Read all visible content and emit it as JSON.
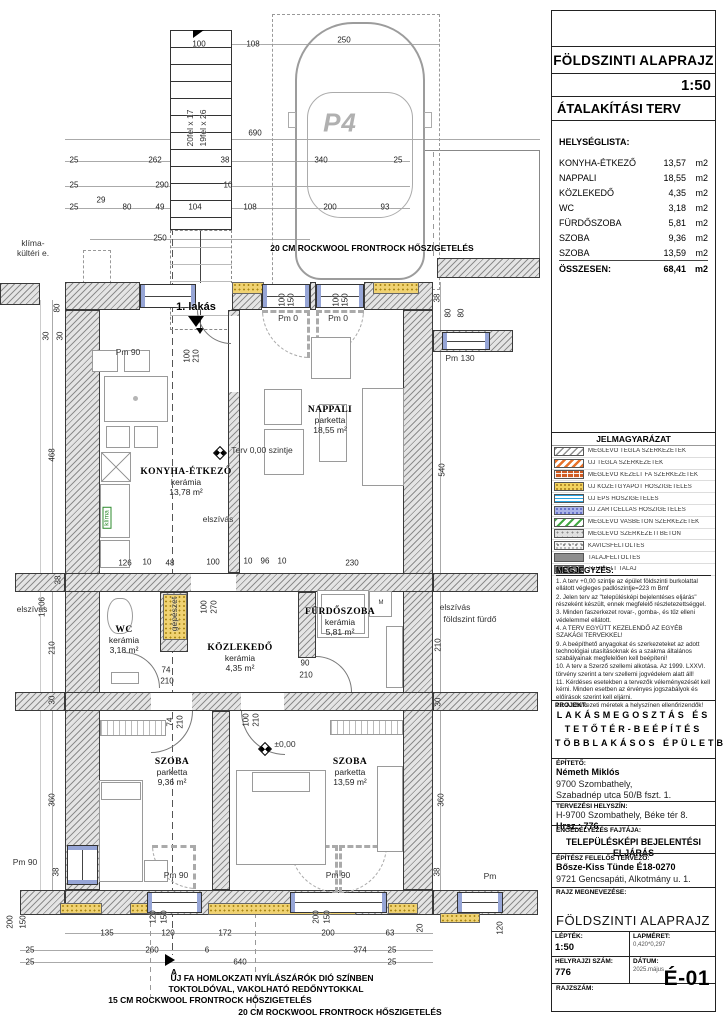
{
  "title_block": {
    "title": "FÖLDSZINTI ALAPRAJZ",
    "scale": "1:50",
    "subtitle": "ÁTALAKÍTÁSI TERV",
    "room_list": {
      "heading": "HELYSÉGLISTA:",
      "rows": [
        {
          "name": "KONYHA-ÉTKEZŐ",
          "area": "13,57",
          "unit": "m2"
        },
        {
          "name": "NAPPALI",
          "area": "18,55",
          "unit": "m2"
        },
        {
          "name": "KÖZLEKEDŐ",
          "area": "4,35",
          "unit": "m2"
        },
        {
          "name": "WC",
          "area": "3,18",
          "unit": "m2"
        },
        {
          "name": "FÜRDŐSZOBA",
          "area": "5,81",
          "unit": "m2"
        },
        {
          "name": "SZOBA",
          "area": "9,36",
          "unit": "m2"
        },
        {
          "name": "SZOBA",
          "area": "13,59",
          "unit": "m2"
        }
      ],
      "total_label": "ÖSSZESEN:",
      "total_area": "68,41",
      "total_unit": "m2"
    },
    "legend": {
      "heading": "JELMAGYARÁZAT",
      "items": [
        {
          "label": "MEGLÉVŐ TÉGLA SZERKEZETEK",
          "cls": "sw1"
        },
        {
          "label": "ÚJ TÉGLA SZERKEZETEK",
          "cls": "sw2"
        },
        {
          "label": "MEGLÉVŐ KEZELT FA SZERKEZETEK",
          "cls": "sw3"
        },
        {
          "label": "ÚJ KŐZETGYAPOT HŐSZIGETELÉS",
          "cls": "sw4"
        },
        {
          "label": "ÚJ EPS HŐSZIGETELÉS",
          "cls": "sw5"
        },
        {
          "label": "ÚJ ZÁRTCELLÁS HŐSZIGETELÉS",
          "cls": "sw6"
        },
        {
          "label": "MEGLÉVŐ VASBETON SZERKEZETEK",
          "cls": "sw7"
        },
        {
          "label": "MEGLÉVŐ SZERKEZETI BETON",
          "cls": "sw8"
        },
        {
          "label": "KAVICSFELTÖLTÉS",
          "cls": "sw9"
        },
        {
          "label": "TALAJFELTÖLTÉS",
          "cls": "sw10"
        },
        {
          "label": "TERMETT TALAJ",
          "cls": "sw11"
        }
      ]
    },
    "notes": {
      "heading": "MEGJEGYZÉS:",
      "items": [
        "1. A terv +0,00 szintje az épület földszinti burkolattal ellátott végleges padlószintje=223 m Bmf",
        "2. Jelen terv az \"településképi bejelentéses eljárás\" részeként készült, ennek megfelelő részletezettséggel.",
        "3. Minden faszerkezet rovar-, gomba-, és tűz elleni védelemmel ellátott.",
        "4. A TERV EGYÜTT KEZELENDŐ AZ EGYÉB SZAKÁGI TERVEKKEL!",
        "9. A beépíthető anyagokat és szerkezeteket az adott technológiai utasításoknak és a szakma általános szabályainak megfelelően kell beépíteni!",
        "10. A terv a Szerző szellemi alkotása. Az 1999. LXXVI. törvény szerint a terv szellemi jogvédelem alatt áll!",
        "11. Kérdéses esetekben a tervezők véleményezését kell kérni. Minden esetben az érvényes jogszabályok és előírások szerint kell eljárni.",
        "12. A szerkezeti méretek a helyszínen ellenőrizendők!"
      ]
    },
    "project": {
      "heading": "PROJEKT:",
      "name_lines": [
        "LAKÁSMEGOSZTÁS ÉS",
        "TETŐTÉR-BEÉPÍTÉS",
        "TÖBBLAKÁSOS ÉPÜLETBEN"
      ],
      "client_label": "ÉPÍTETŐ:",
      "client_name": "Németh Miklós",
      "client_addr1": "9700 Szombathely,",
      "client_addr2": "Szabadnép utca 50/B fszt. 1.",
      "site_label": "TERVEZÉSI HELYSZÍN:",
      "site_addr": "H-9700 Szombathely, Béke tér 8.",
      "site_parcel": "Hrsz.: 776",
      "permit_label": "ENGEDÉLYEZÉS FAJTÁJA:",
      "permit_value": "TELEPÜLÉSKÉPI BEJELENTÉSI ELJÁRÁS",
      "architect_label": "ÉPÍTÉSZ FELELŐS TERVEZŐ:",
      "architect_name": "Bősze-Kiss Tünde É18-0270",
      "architect_addr": "9721 Gencsapáti, Alkotmány u. 1."
    },
    "footer": {
      "drawing_name_label": "RAJZ MEGNEVEZÉSE:",
      "drawing_name": "FÖLDSZINTI ALAPRAJZ",
      "scale_label": "LÉPTÉK:",
      "scale_value": "1:50",
      "sheet_size_label": "LAPMÉRET:",
      "sheet_size_value": "0,420*0,297",
      "parcel_label": "HELYRAJZI SZÁM:",
      "parcel_value": "776",
      "date_label": "DÁTUM:",
      "date_value": "2025.május",
      "drawing_no_label": "RAJZSZÁM:",
      "drawing_no_value": "É-01"
    }
  },
  "plan": {
    "rooms": [
      {
        "name": "KONYHA-ÉTKEZŐ",
        "finish": "kerámia",
        "area": "13,78 m²",
        "x": 186,
        "y": 482
      },
      {
        "name": "NAPPALI",
        "finish": "parketta",
        "area": "18,55 m²",
        "x": 330,
        "y": 420
      },
      {
        "name": "WC",
        "finish": "kerámia",
        "area": "3,18 m²",
        "x": 124,
        "y": 640
      },
      {
        "name": "KÖZLEKEDŐ",
        "finish": "kerámia",
        "area": "4,35 m²",
        "x": 240,
        "y": 658
      },
      {
        "name": "FÜRDŐSZOBA",
        "finish": "kerámia",
        "area": "5,81 m²",
        "x": 340,
        "y": 622
      },
      {
        "name": "SZOBA",
        "finish": "parketta",
        "area": "9,36 m²",
        "x": 172,
        "y": 772
      },
      {
        "name": "SZOBA",
        "finish": "parketta",
        "area": "13,59 m²",
        "x": 350,
        "y": 772
      }
    ],
    "annotations": [
      {
        "t": "klíma-",
        "x": 33,
        "y": 243
      },
      {
        "t": "kültéri e.",
        "x": 33,
        "y": 253
      },
      {
        "t": "20 CM ROCKWOOL FRONTROCK HŐSZIGETELÉS",
        "x": 372,
        "y": 248,
        "cls": "b"
      },
      {
        "t": "1. lakás",
        "x": 196,
        "y": 307,
        "cls": "b sec"
      },
      {
        "t": "Pm 90",
        "x": 128,
        "y": 352
      },
      {
        "t": "Pm 0",
        "x": 288,
        "y": 318
      },
      {
        "t": "Pm 0",
        "x": 338,
        "y": 318
      },
      {
        "t": "Pm 130",
        "x": 460,
        "y": 358
      },
      {
        "t": "Terv 0,00 szintje",
        "x": 262,
        "y": 450
      },
      {
        "t": "elszívás",
        "x": 218,
        "y": 519
      },
      {
        "t": "elszívás",
        "x": 32,
        "y": 609
      },
      {
        "t": "elszívás",
        "x": 455,
        "y": 607
      },
      {
        "t": "földszint fürdő",
        "x": 470,
        "y": 619
      },
      {
        "t": "gépészet",
        "x": 174,
        "y": 614,
        "cls": "v"
      },
      {
        "t": "klíma",
        "x": 107,
        "y": 518,
        "cls": "g"
      },
      {
        "t": "20fel x 17",
        "x": 190,
        "y": 128,
        "cls": "v"
      },
      {
        "t": "19fel x 26",
        "x": 203,
        "y": 128,
        "cls": "v"
      },
      {
        "t": "P4",
        "x": 340,
        "y": 123,
        "cls": "p4"
      },
      {
        "t": "±0,00",
        "x": 285,
        "y": 744
      },
      {
        "t": "M",
        "x": 381,
        "y": 603,
        "cls": "tiny"
      },
      {
        "t": "Pm 90",
        "x": 176,
        "y": 875
      },
      {
        "t": "Pm 90",
        "x": 338,
        "y": 875
      },
      {
        "t": "Pm 90",
        "x": 25,
        "y": 862
      },
      {
        "t": "Pm",
        "x": 490,
        "y": 876
      },
      {
        "t": "A",
        "x": 174,
        "y": 972,
        "cls": "b"
      },
      {
        "t": "ÚJ FA HOMLOKZATI NYÍLÁSZÁRÓK DIÓ SZÍNBEN",
        "x": 272,
        "y": 978,
        "cls": "nb"
      },
      {
        "t": "TOKTOLDÓVAL, VAKOLHATÓ REDŐNYTOKKAL",
        "x": 266,
        "y": 989,
        "cls": "nb"
      },
      {
        "t": "15 CM ROCKWOOL FRONTROCK HŐSZIGETELÉS",
        "x": 210,
        "y": 1000,
        "cls": "nb"
      },
      {
        "t": "20 CM ROCKWOOL FRONTROCK HŐSZIGETELÉS",
        "x": 340,
        "y": 1012,
        "cls": "nb"
      }
    ],
    "dimensions": [
      {
        "t": "100",
        "x": 199,
        "y": 44
      },
      {
        "t": "108",
        "x": 253,
        "y": 44
      },
      {
        "t": "250",
        "x": 344,
        "y": 40
      },
      {
        "t": "690",
        "x": 255,
        "y": 133
      },
      {
        "t": "25",
        "x": 74,
        "y": 160
      },
      {
        "t": "262",
        "x": 155,
        "y": 160
      },
      {
        "t": "38",
        "x": 225,
        "y": 160
      },
      {
        "t": "340",
        "x": 321,
        "y": 160
      },
      {
        "t": "25",
        "x": 398,
        "y": 160
      },
      {
        "t": "25",
        "x": 74,
        "y": 185
      },
      {
        "t": "290",
        "x": 162,
        "y": 185
      },
      {
        "t": "10",
        "x": 228,
        "y": 185
      },
      {
        "t": "25",
        "x": 74,
        "y": 207
      },
      {
        "t": "29",
        "x": 101,
        "y": 200
      },
      {
        "t": "80",
        "x": 127,
        "y": 207
      },
      {
        "t": "49",
        "x": 160,
        "y": 207
      },
      {
        "t": "104",
        "x": 195,
        "y": 207
      },
      {
        "t": "108",
        "x": 250,
        "y": 207
      },
      {
        "t": "200",
        "x": 330,
        "y": 207
      },
      {
        "t": "93",
        "x": 385,
        "y": 207
      },
      {
        "t": "250",
        "x": 160,
        "y": 238
      },
      {
        "t": "80",
        "x": 57,
        "y": 308,
        "cls": "v"
      },
      {
        "t": "30",
        "x": 46,
        "y": 336,
        "cls": "v"
      },
      {
        "t": "30",
        "x": 60,
        "y": 336,
        "cls": "v"
      },
      {
        "t": "468",
        "x": 52,
        "y": 455,
        "cls": "v"
      },
      {
        "t": "38",
        "x": 58,
        "y": 580,
        "cls": "v"
      },
      {
        "t": "1 106",
        "x": 42,
        "y": 607,
        "cls": "v"
      },
      {
        "t": "210",
        "x": 52,
        "y": 648,
        "cls": "v"
      },
      {
        "t": "30",
        "x": 52,
        "y": 700,
        "cls": "v"
      },
      {
        "t": "360",
        "x": 52,
        "y": 800,
        "cls": "v"
      },
      {
        "t": "38",
        "x": 56,
        "y": 872,
        "cls": "v"
      },
      {
        "t": "200",
        "x": 10,
        "y": 922,
        "cls": "v"
      },
      {
        "t": "150",
        "x": 23,
        "y": 922,
        "cls": "v"
      },
      {
        "t": "38",
        "x": 437,
        "y": 298,
        "cls": "v"
      },
      {
        "t": "80",
        "x": 448,
        "y": 313,
        "cls": "v"
      },
      {
        "t": "80",
        "x": 461,
        "y": 313,
        "cls": "v"
      },
      {
        "t": "540",
        "x": 442,
        "y": 470,
        "cls": "v"
      },
      {
        "t": "210",
        "x": 438,
        "y": 645,
        "cls": "v"
      },
      {
        "t": "30",
        "x": 438,
        "y": 702,
        "cls": "v"
      },
      {
        "t": "360",
        "x": 441,
        "y": 800,
        "cls": "v"
      },
      {
        "t": "38",
        "x": 437,
        "y": 872,
        "cls": "v"
      },
      {
        "t": "20",
        "x": 420,
        "y": 928,
        "cls": "v"
      },
      {
        "t": "120",
        "x": 500,
        "y": 928,
        "cls": "v"
      },
      {
        "t": "126",
        "x": 125,
        "y": 563
      },
      {
        "t": "10",
        "x": 147,
        "y": 562
      },
      {
        "t": "48",
        "x": 170,
        "y": 563
      },
      {
        "t": "100",
        "x": 213,
        "y": 562
      },
      {
        "t": "10",
        "x": 248,
        "y": 561
      },
      {
        "t": "96",
        "x": 265,
        "y": 561
      },
      {
        "t": "10",
        "x": 282,
        "y": 561
      },
      {
        "t": "230",
        "x": 352,
        "y": 563
      },
      {
        "t": "100",
        "x": 282,
        "y": 300,
        "cls": "v"
      },
      {
        "t": "150",
        "x": 291,
        "y": 300,
        "cls": "v"
      },
      {
        "t": "100",
        "x": 336,
        "y": 300,
        "cls": "v"
      },
      {
        "t": "150",
        "x": 345,
        "y": 300,
        "cls": "v"
      },
      {
        "t": "100",
        "x": 187,
        "y": 356,
        "cls": "v"
      },
      {
        "t": "210",
        "x": 196,
        "y": 356,
        "cls": "v"
      },
      {
        "t": "100",
        "x": 204,
        "y": 607,
        "cls": "v"
      },
      {
        "t": "270",
        "x": 214,
        "y": 607,
        "cls": "v"
      },
      {
        "t": "74",
        "x": 166,
        "y": 670
      },
      {
        "t": "210",
        "x": 167,
        "y": 681
      },
      {
        "t": "90",
        "x": 305,
        "y": 663
      },
      {
        "t": "210",
        "x": 306,
        "y": 675
      },
      {
        "t": "74",
        "x": 170,
        "y": 722,
        "cls": "v"
      },
      {
        "t": "210",
        "x": 180,
        "y": 722,
        "cls": "v"
      },
      {
        "t": "100",
        "x": 246,
        "y": 720,
        "cls": "v"
      },
      {
        "t": "210",
        "x": 256,
        "y": 720,
        "cls": "v"
      },
      {
        "t": "135",
        "x": 107,
        "y": 933
      },
      {
        "t": "120",
        "x": 168,
        "y": 933
      },
      {
        "t": "172",
        "x": 225,
        "y": 933
      },
      {
        "t": "200",
        "x": 328,
        "y": 933
      },
      {
        "t": "63",
        "x": 390,
        "y": 933
      },
      {
        "t": "25",
        "x": 30,
        "y": 950
      },
      {
        "t": "260",
        "x": 152,
        "y": 950
      },
      {
        "t": "6",
        "x": 207,
        "y": 950
      },
      {
        "t": "374",
        "x": 360,
        "y": 950
      },
      {
        "t": "25",
        "x": 392,
        "y": 950
      },
      {
        "t": "25",
        "x": 30,
        "y": 962
      },
      {
        "t": "640",
        "x": 240,
        "y": 962
      },
      {
        "t": "25",
        "x": 392,
        "y": 962
      },
      {
        "t": "120",
        "x": 153,
        "y": 917,
        "cls": "v"
      },
      {
        "t": "150",
        "x": 164,
        "y": 917,
        "cls": "v"
      },
      {
        "t": "200",
        "x": 316,
        "y": 917,
        "cls": "v"
      },
      {
        "t": "150",
        "x": 327,
        "y": 917,
        "cls": "v"
      }
    ]
  }
}
